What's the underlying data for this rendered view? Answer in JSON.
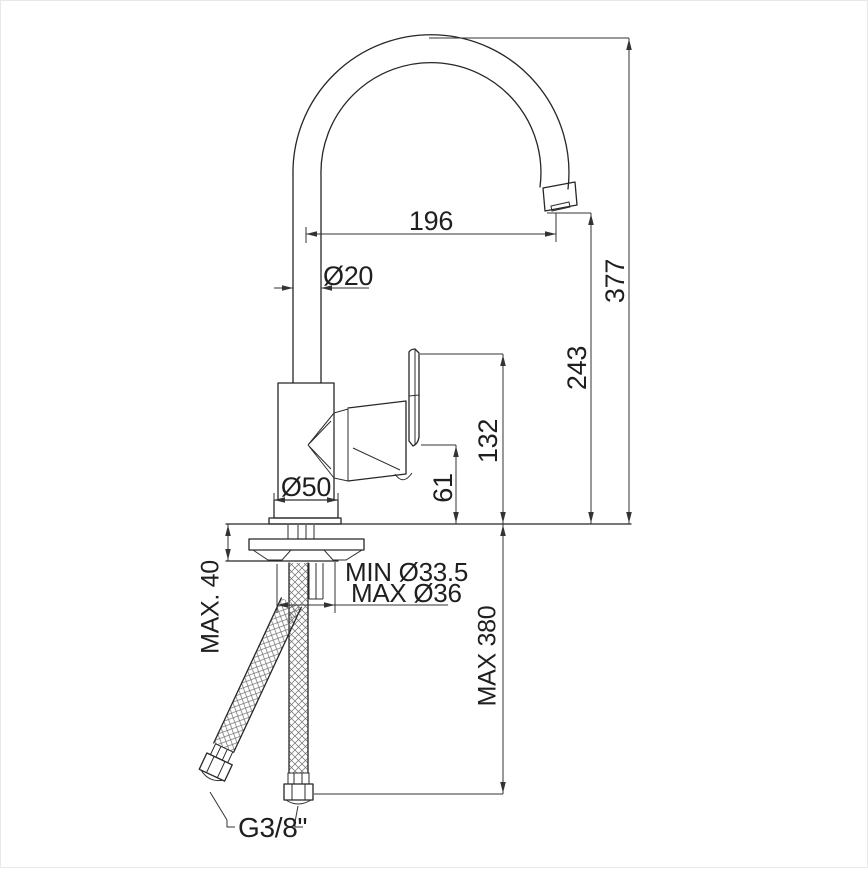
{
  "drawing": {
    "kind": "single-lever kitchen faucet installation diagram"
  },
  "dims": {
    "spout_reach": "196",
    "spout_diameter": "Ø20",
    "total_height": "377",
    "outlet_height": "243",
    "handle_top_height": "132",
    "body_top_height": "61",
    "base_diameter": "Ø50",
    "max_deck_thickness": "MAX. 40",
    "hole_diameter_min": "MIN Ø33.5",
    "hole_diameter_max": "MAX Ø36",
    "max_hose_length": "MAX 380",
    "hose_thread": "G3/8\""
  }
}
